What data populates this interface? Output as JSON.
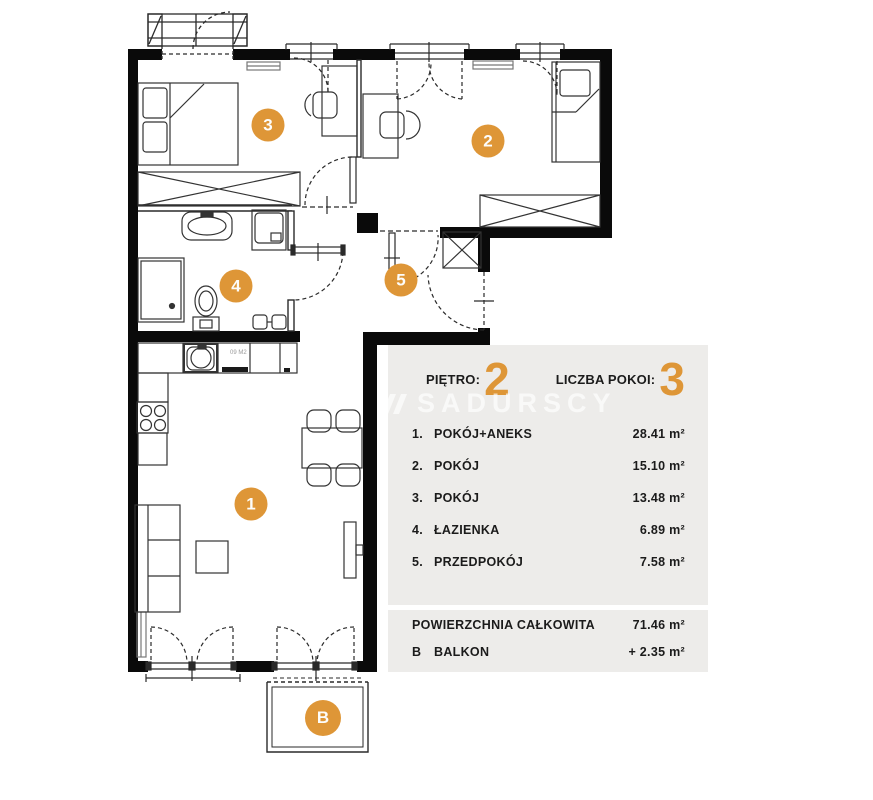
{
  "colors": {
    "accent_orange": "#DE9637",
    "panel_bg": "#EDECEA",
    "wall_black": "#0a0a0a"
  },
  "floorplan": {
    "rooms": [
      {
        "id": "1"
      },
      {
        "id": "2"
      },
      {
        "id": "3"
      },
      {
        "id": "4"
      },
      {
        "id": "5"
      },
      {
        "id": "B"
      }
    ],
    "kitchen_label": "09 M2"
  },
  "panel": {
    "floor_label": "PIĘTRO:",
    "floor_value": "2",
    "rooms_label": "LICZBA POKOI:",
    "rooms_value": "3",
    "watermark": "SADURSCY",
    "room_list": [
      {
        "num": "1.",
        "name": "POKÓJ+ANEKS",
        "area": "28.41 m²"
      },
      {
        "num": "2.",
        "name": "POKÓJ",
        "area": "15.10 m²"
      },
      {
        "num": "3.",
        "name": "POKÓJ",
        "area": "13.48 m²"
      },
      {
        "num": "4.",
        "name": "ŁAZIENKA",
        "area": "6.89 m²"
      },
      {
        "num": "5.",
        "name": "PRZEDPOKÓJ",
        "area": "7.58 m²"
      }
    ],
    "totals": [
      {
        "num": "",
        "name": "POWIERZCHNIA CAŁKOWITA",
        "area": "71.46 m²"
      },
      {
        "num": "B",
        "name": "BALKON",
        "area": "+ 2.35 m²"
      }
    ]
  }
}
